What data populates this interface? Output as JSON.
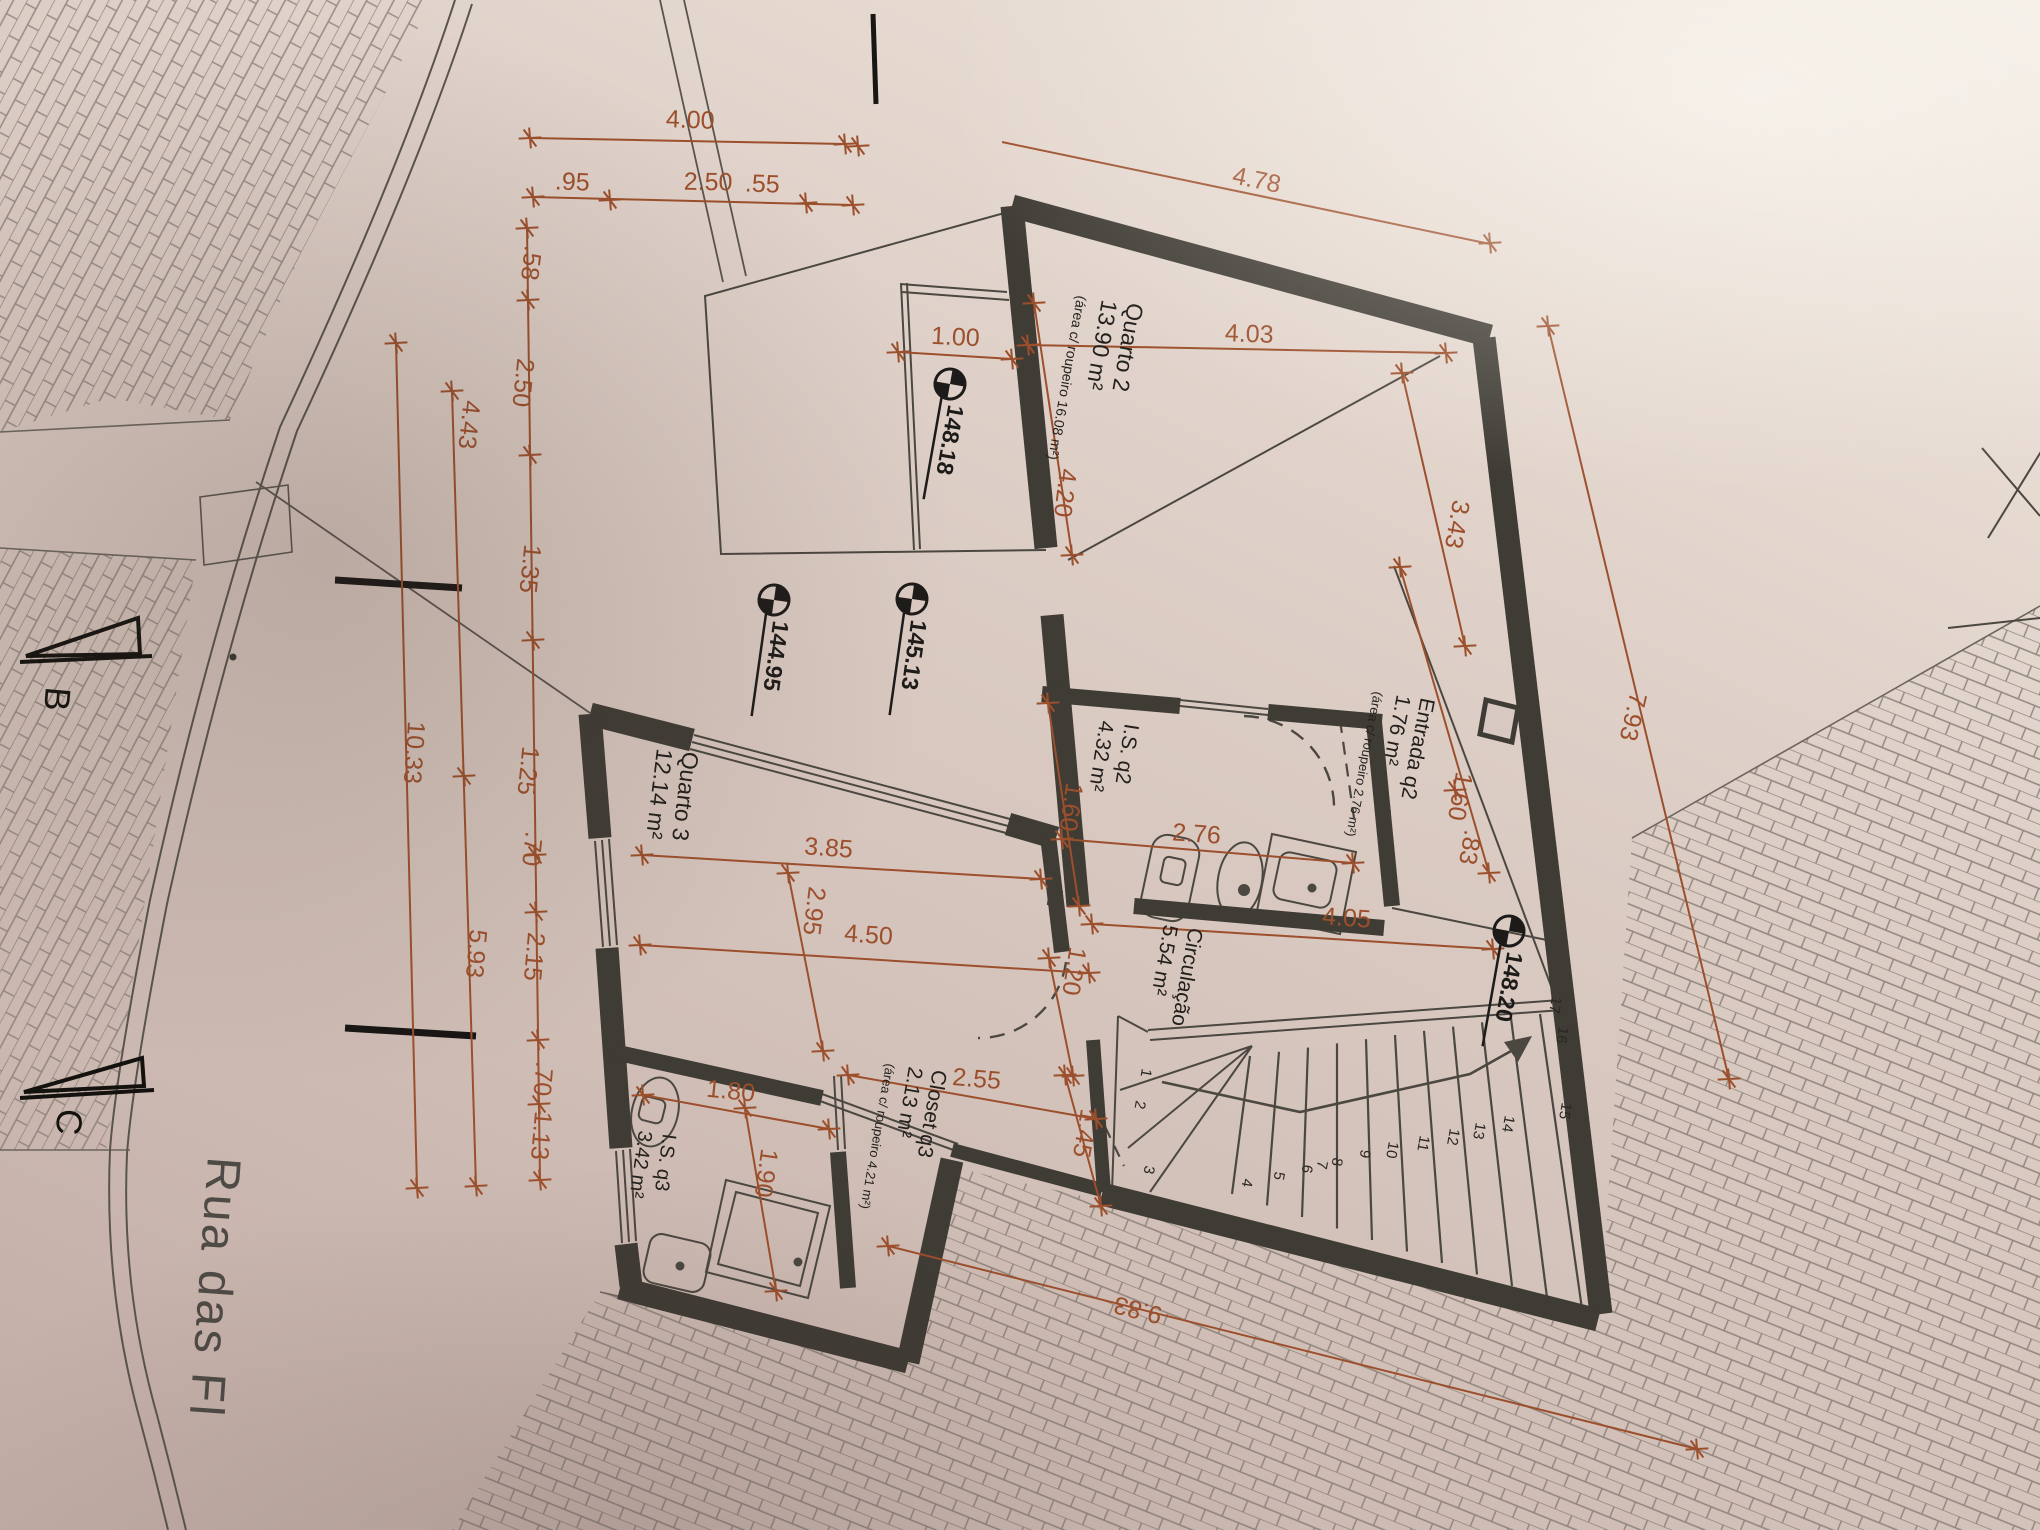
{
  "scene": {
    "description": "Photographed architectural floor plan (rotated sheet)",
    "street_label": "Rua das Fl"
  },
  "colors": {
    "dimension": "#a14e28",
    "wall": "#3f3b35",
    "line": "#4b4741",
    "text": "#1f1d1b",
    "paper": "#d8c8c0"
  },
  "rooms": [
    {
      "id": "quarto2",
      "x": 1128,
      "y": 302,
      "rot": 100,
      "lines": [
        {
          "t": "Quarto 2",
          "dx": 0,
          "dy": 0,
          "fs": 23
        },
        {
          "t": "13.90 m²",
          "dx": -26,
          "dy": -3,
          "fs": 23
        },
        {
          "t": "(área c/ roupeiro 16.08 m²)",
          "dx": -51,
          "dy": -7,
          "fs": 14
        }
      ]
    },
    {
      "id": "entrada-q2",
      "x": 1421,
      "y": 697,
      "rot": 101,
      "lines": [
        {
          "t": "Entrada q2",
          "dx": 0,
          "dy": 0,
          "fs": 21
        },
        {
          "t": "1.76 m²",
          "dx": -24,
          "dy": -3,
          "fs": 21
        },
        {
          "t": "(área c/ roupeiro 2.76 m²)",
          "dx": -47,
          "dy": -6,
          "fs": 13
        }
      ]
    },
    {
      "id": "is-q2",
      "x": 1125,
      "y": 723,
      "rot": 99,
      "lines": [
        {
          "t": "I.S. q2",
          "dx": 0,
          "dy": 0,
          "fs": 21
        },
        {
          "t": "4.32 m²",
          "dx": -25,
          "dy": -3,
          "fs": 21
        }
      ]
    },
    {
      "id": "quarto3",
      "x": 683,
      "y": 751,
      "rot": 97,
      "lines": [
        {
          "t": "Quarto 3",
          "dx": 0,
          "dy": 0,
          "fs": 23
        },
        {
          "t": "12.14 m²",
          "dx": -26,
          "dy": -3,
          "fs": 23
        }
      ]
    },
    {
      "id": "circulacao",
      "x": 1189,
      "y": 927,
      "rot": 100,
      "lines": [
        {
          "t": "Circulação",
          "dx": 0,
          "dy": 0,
          "fs": 21
        },
        {
          "t": "5.54 m²",
          "dx": -25,
          "dy": -3,
          "fs": 21
        }
      ]
    },
    {
      "id": "closet-q3",
      "x": 933,
      "y": 1069,
      "rot": 100,
      "lines": [
        {
          "t": "Closet q3",
          "dx": 0,
          "dy": 0,
          "fs": 21
        },
        {
          "t": "2.13 m²",
          "dx": -24,
          "dy": -3,
          "fs": 21
        },
        {
          "t": "(área c/ roupeiro 4.21 m²)",
          "dx": -47,
          "dy": -6,
          "fs": 13
        }
      ]
    },
    {
      "id": "is-q3",
      "x": 663,
      "y": 1133,
      "rot": 98,
      "lines": [
        {
          "t": "I.S. q3",
          "dx": 0,
          "dy": 0,
          "fs": 20
        },
        {
          "t": "3.42 m²",
          "dx": -24,
          "dy": -3,
          "fs": 20
        }
      ]
    }
  ],
  "elevations": [
    {
      "v": "148.18",
      "x": 950,
      "y": 384,
      "rot": 100
    },
    {
      "v": "144.95",
      "x": 774,
      "y": 600,
      "rot": 98
    },
    {
      "v": "145.13",
      "x": 912,
      "y": 599,
      "rot": 98
    },
    {
      "v": "148.20",
      "x": 1509,
      "y": 931,
      "rot": 100
    }
  ],
  "dimensions": [
    {
      "t": "4.00",
      "x": 690,
      "y": 128,
      "r": 2
    },
    {
      "t": ".95",
      "x": 572,
      "y": 190,
      "r": 2
    },
    {
      "t": "2.50",
      "x": 708,
      "y": 190,
      "r": 1
    },
    {
      "t": ".55",
      "x": 762,
      "y": 192,
      "r": 2
    },
    {
      "t": "4.78",
      "x": 1255,
      "y": 188,
      "r": 12
    },
    {
      "t": "1.00",
      "x": 955,
      "y": 345,
      "r": 3
    },
    {
      "t": "4.03",
      "x": 1249,
      "y": 342,
      "r": 2
    },
    {
      "t": "4.20",
      "x": 1057,
      "y": 492,
      "r": 97
    },
    {
      "t": "3.43",
      "x": 1449,
      "y": 523,
      "r": 100
    },
    {
      "t": "7.93",
      "x": 1625,
      "y": 715,
      "r": 103
    },
    {
      "t": "1.60",
      "x": 1452,
      "y": 795,
      "r": 100
    },
    {
      "t": ".83",
      "x": 1462,
      "y": 846,
      "r": 100
    },
    {
      "t": "4.05",
      "x": 1346,
      "y": 926,
      "r": 4
    },
    {
      "t": "2.76",
      "x": 1196,
      "y": 842,
      "r": 4
    },
    {
      "t": "1.60",
      "x": 1063,
      "y": 806,
      "r": 98
    },
    {
      "t": "3.85",
      "x": 828,
      "y": 856,
      "r": 4
    },
    {
      "t": "2.95",
      "x": 806,
      "y": 910,
      "r": 97
    },
    {
      "t": "4.50",
      "x": 868,
      "y": 943,
      "r": 4
    },
    {
      "t": "1.20",
      "x": 1066,
      "y": 970,
      "r": 99
    },
    {
      "t": "2.55",
      "x": 976,
      "y": 1087,
      "r": 5
    },
    {
      "t": "1.45",
      "x": 1077,
      "y": 1132,
      "r": 100
    },
    {
      "t": "1.80",
      "x": 730,
      "y": 1099,
      "r": 6
    },
    {
      "t": "1.90",
      "x": 758,
      "y": 1172,
      "r": 98
    },
    {
      "t": "9.83",
      "x": 1140,
      "y": 1302,
      "r": 194
    },
    {
      "t": ".58",
      "x": 523,
      "y": 262,
      "r": 97
    },
    {
      "t": "2.50",
      "x": 515,
      "y": 382,
      "r": 96
    },
    {
      "t": "4.43",
      "x": 461,
      "y": 424,
      "r": 96
    },
    {
      "t": "1.35",
      "x": 522,
      "y": 568,
      "r": 96
    },
    {
      "t": "10.33",
      "x": 406,
      "y": 752,
      "r": 94
    },
    {
      "t": "1.25",
      "x": 520,
      "y": 770,
      "r": 96
    },
    {
      "t": ".70",
      "x": 524,
      "y": 848,
      "r": 96
    },
    {
      "t": "2.15",
      "x": 526,
      "y": 956,
      "r": 95
    },
    {
      "t": "5.93",
      "x": 468,
      "y": 953,
      "r": 95
    },
    {
      "t": ".70",
      "x": 535,
      "y": 1078,
      "r": 95
    },
    {
      "t": "1.13",
      "x": 533,
      "y": 1135,
      "r": 95
    }
  ],
  "stair_numbers": [
    {
      "n": "1",
      "x": 1142,
      "y": 1068
    },
    {
      "n": "2",
      "x": 1136,
      "y": 1100
    },
    {
      "n": "3",
      "x": 1145,
      "y": 1165
    },
    {
      "n": "4",
      "x": 1243,
      "y": 1178
    },
    {
      "n": "5",
      "x": 1275,
      "y": 1171
    },
    {
      "n": "6",
      "x": 1303,
      "y": 1164
    },
    {
      "n": "7",
      "x": 1318,
      "y": 1160
    },
    {
      "n": "8",
      "x": 1333,
      "y": 1157
    },
    {
      "n": "9",
      "x": 1361,
      "y": 1149
    },
    {
      "n": "10",
      "x": 1389,
      "y": 1141
    },
    {
      "n": "11",
      "x": 1420,
      "y": 1135
    },
    {
      "n": "12",
      "x": 1450,
      "y": 1128
    },
    {
      "n": "13",
      "x": 1476,
      "y": 1122
    },
    {
      "n": "14",
      "x": 1505,
      "y": 1115
    },
    {
      "n": "15",
      "x": 1562,
      "y": 1102
    },
    {
      "n": "16",
      "x": 1559,
      "y": 1026
    },
    {
      "n": "17",
      "x": 1552,
      "y": 996
    }
  ],
  "markers": [
    {
      "label": "B",
      "lx": 46,
      "ly": 686,
      "tri": "138,618 26,656 140,654",
      "base": "20,662 152,656"
    },
    {
      "label": "C",
      "lx": 58,
      "ly": 1108,
      "tri": "142,1058 24,1092 144,1086",
      "base": "20,1098 154,1090"
    }
  ]
}
